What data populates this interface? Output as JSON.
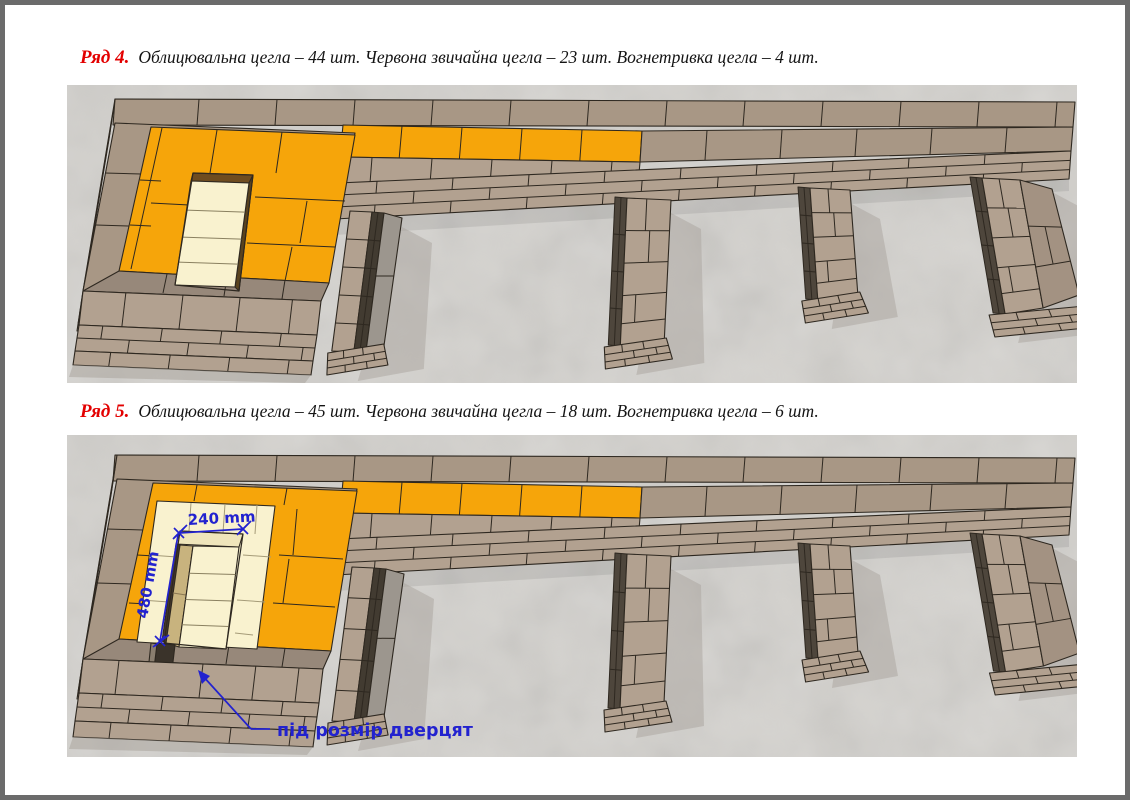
{
  "rows": [
    {
      "label": "Ряд 4.",
      "description": "Облицювальна цегла – 44 шт. Червона звичайна цегла – 23 шт. Вогнетривка цегла – 4 шт."
    },
    {
      "label": "Ряд 5.",
      "description": "Облицювальна цегла – 45 шт. Червона звичайна цегла – 18 шт. Вогнетривка цегла – 6 шт."
    }
  ],
  "figure2_annotations": {
    "dim_width": "240 mm",
    "dim_height": "480 mm",
    "door_note": "під розмір дверцят"
  },
  "colors": {
    "heading_red": "#e30000",
    "text_black": "#141414",
    "annotation_blue": "#2222cf",
    "brick_orange": "#f6a50a",
    "brick_tan_top": "#a89785",
    "brick_tan_side": "#b2a190",
    "brick_tan_dark": "#97887a",
    "brick_gray_shade": "#9c968e",
    "brick_cream": "#f9f2cf",
    "brick_cream_side": "#efe5bb",
    "jamb_brown": "#c8b37e",
    "dark_slot": "#3a332a",
    "mortar_line": "#2e2820",
    "concrete_bg": "#d4d2ce",
    "shadow_gray": "#aaa49d",
    "page_border": "#6b6b6b"
  }
}
